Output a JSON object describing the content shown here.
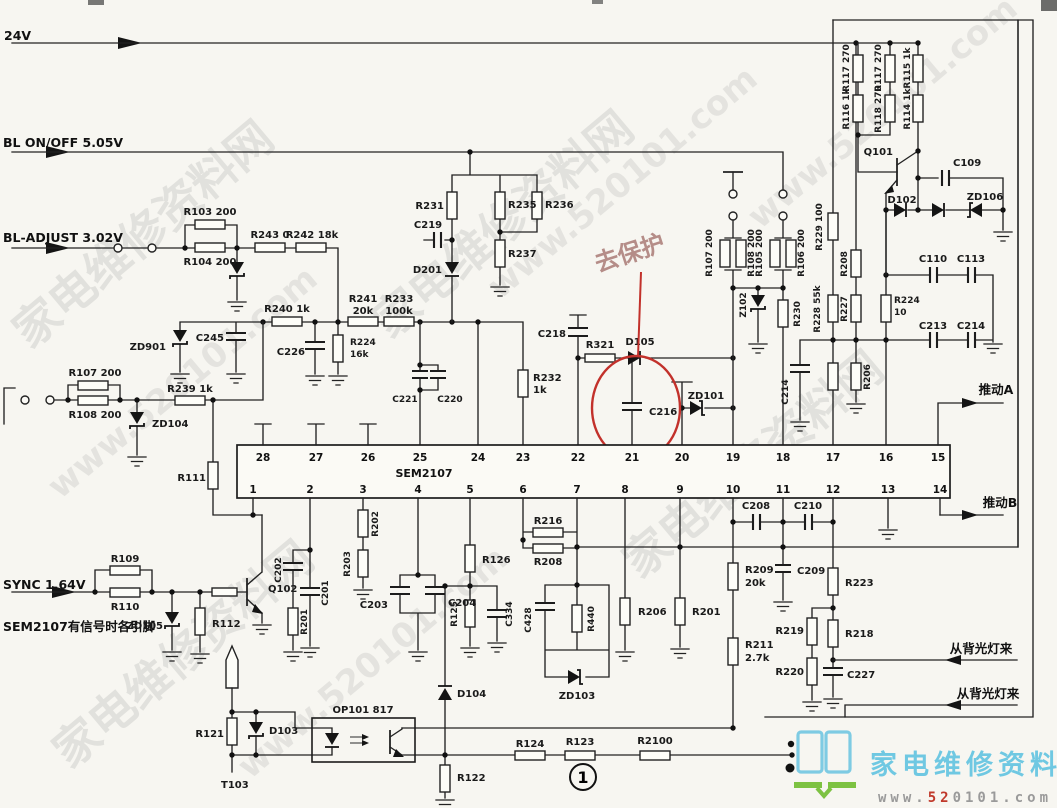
{
  "inputs": {
    "v24": "24V",
    "bl_onoff": "BL ON/OFF 5.05V",
    "bl_adjust": "BL-ADJUST 3.02V",
    "sync": "SYNC 1.64V",
    "note": "SEM2107有信号时各引脚"
  },
  "outputs": {
    "push_a": "推动A",
    "push_b": "推动B",
    "from_backlight_1": "从背光灯来",
    "from_backlight_2": "从背光灯来"
  },
  "annotations": {
    "protect": "去保护",
    "page_num": "1"
  },
  "ic": {
    "name": "SEM2107",
    "pins_top": [
      "28",
      "27",
      "26",
      "25",
      "24",
      "23",
      "22",
      "21",
      "20",
      "19",
      "18",
      "17",
      "16",
      "15"
    ],
    "pins_bottom": [
      "1",
      "2",
      "3",
      "4",
      "5",
      "6",
      "7",
      "8",
      "9",
      "10",
      "11",
      "12",
      "13",
      "14"
    ]
  },
  "c": {
    "r103": "R103 200",
    "r104": "R104 200",
    "r243": "R243 0",
    "r242": "R242 18k",
    "zd901": "ZD901",
    "c245": "C245",
    "r240": "R240 1k",
    "r241": "R241",
    "r241v": "20k",
    "r233": "R233",
    "r233v": "100k",
    "c226": "C226",
    "r224a": "R224",
    "r224av": "16k",
    "r107a": "R107 200",
    "r108a": "R108 200",
    "r239": "R239 1k",
    "zd104": "ZD104",
    "r111": "R111",
    "r231": "R231",
    "c219": "C219",
    "d201": "D201",
    "r235": "R235",
    "r236": "R236",
    "r237": "R237",
    "c221": "C221",
    "c220": "C220",
    "r232": "R232",
    "r232v": "1k",
    "c218": "C218",
    "r321": "R321",
    "d105": "D105",
    "c216": "C216",
    "zd101": "ZD101",
    "r107b": "R107 200",
    "r108b": "R108 200",
    "r105": "R105 200",
    "r106": "R106 200",
    "z102": "Z102",
    "r230": "R230",
    "r229": "R229 100",
    "r208a": "R208",
    "r228": "R228 55k",
    "r227": "R227",
    "c214a": "C214",
    "r206a": "R206",
    "r224b": "R224",
    "r224bv": "10",
    "c110": "C110",
    "c113": "C113",
    "c213": "C213",
    "c214b": "C214",
    "r117a": "R117 270",
    "r116": "R116 1k",
    "r117b": "R117 270",
    "r118": "R118 270",
    "r115": "R115 1k",
    "r114": "R114 1k",
    "q101": "Q101",
    "c109": "C109",
    "d102": "D102",
    "zd106": "ZD106",
    "r109": "R109",
    "r110": "R110",
    "zd105": "ZD105",
    "r112": "R112",
    "q102": "Q102",
    "c202": "C202",
    "c201": "C201",
    "r201a": "R201",
    "r202": "R202",
    "r203": "R203",
    "c203": "C203",
    "c204": "C204",
    "r126": "R126",
    "r125": "R125",
    "c334": "C334",
    "c428": "C428",
    "r440": "R440",
    "d104": "D104",
    "zd103": "ZD103",
    "r216": "R216",
    "r208b": "R208",
    "r206b": "R206",
    "r201b": "R201",
    "c208": "C208",
    "c210": "C210",
    "r209": "R209",
    "r209v": "20k",
    "c209": "C209",
    "r211": "R211",
    "r211v": "2.7k",
    "r223": "R223",
    "r219": "R219",
    "r218": "R218",
    "r220": "R220",
    "c227": "C227",
    "r121": "R121",
    "d103": "D103",
    "t103": "T103",
    "op101": "OP101 817",
    "r122": "R122",
    "r124": "R124",
    "r123": "R123",
    "r2100": "R2100"
  },
  "watermark": {
    "site": "家电维修资料网",
    "url": "www.520101.com"
  },
  "logo": {
    "site": "家电维修资料网",
    "url_pre": "www.",
    "url_mid": "52",
    "url_post": "0101.com"
  },
  "colors": {
    "annotation_red": "#c2312b",
    "logo_blue": "#6fc8e2",
    "logo_green": "#7dc242",
    "url_gray": "#9a9a9a",
    "ink": "#1a1a1a"
  }
}
